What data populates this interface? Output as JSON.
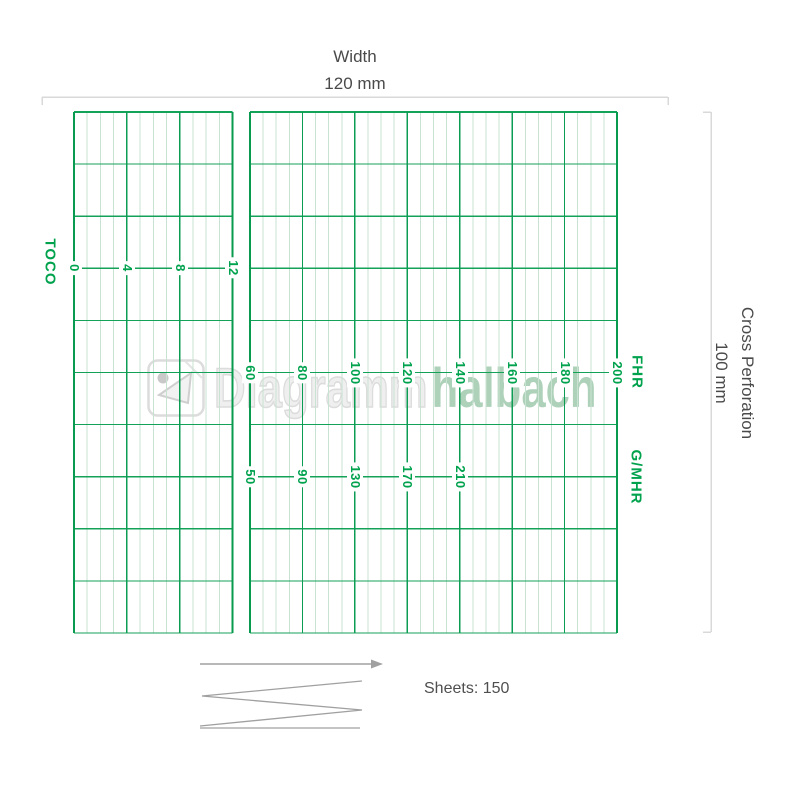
{
  "dimensions": {
    "width_label": "Width",
    "width_value": "120 mm",
    "cross_perforation_label": "Cross Perforation",
    "cross_perforation_value": "100 mm"
  },
  "scales": {
    "toco": {
      "title": "TOCO",
      "ticks": [
        "0",
        "4",
        "8",
        "12"
      ]
    },
    "fhr": {
      "title": "FHR",
      "ticks": [
        "60",
        "80",
        "100",
        "120",
        "140",
        "160",
        "180",
        "200"
      ]
    },
    "gmhr": {
      "title": "G/MHR",
      "ticks": [
        "50",
        "90",
        "130",
        "170",
        "210"
      ]
    }
  },
  "watermark": {
    "brand_word_1": "Diagramm",
    "brand_word_2": "halbach"
  },
  "footer": {
    "sheets_text": "Sheets: 150"
  },
  "colors": {
    "grid_border": "#089a4e",
    "grid_major": "#0d9c53",
    "grid_horizontal": "#14a259",
    "grid_minor": "#c9e3d3",
    "label_green": "#00a24e",
    "dimension_gray": "#d9d9d9",
    "text_gray": "#4a4a4a",
    "fold_gray": "#a0a0a0",
    "watermark_outline": "#dcdcdc",
    "watermark_green": "#aed1b9"
  }
}
